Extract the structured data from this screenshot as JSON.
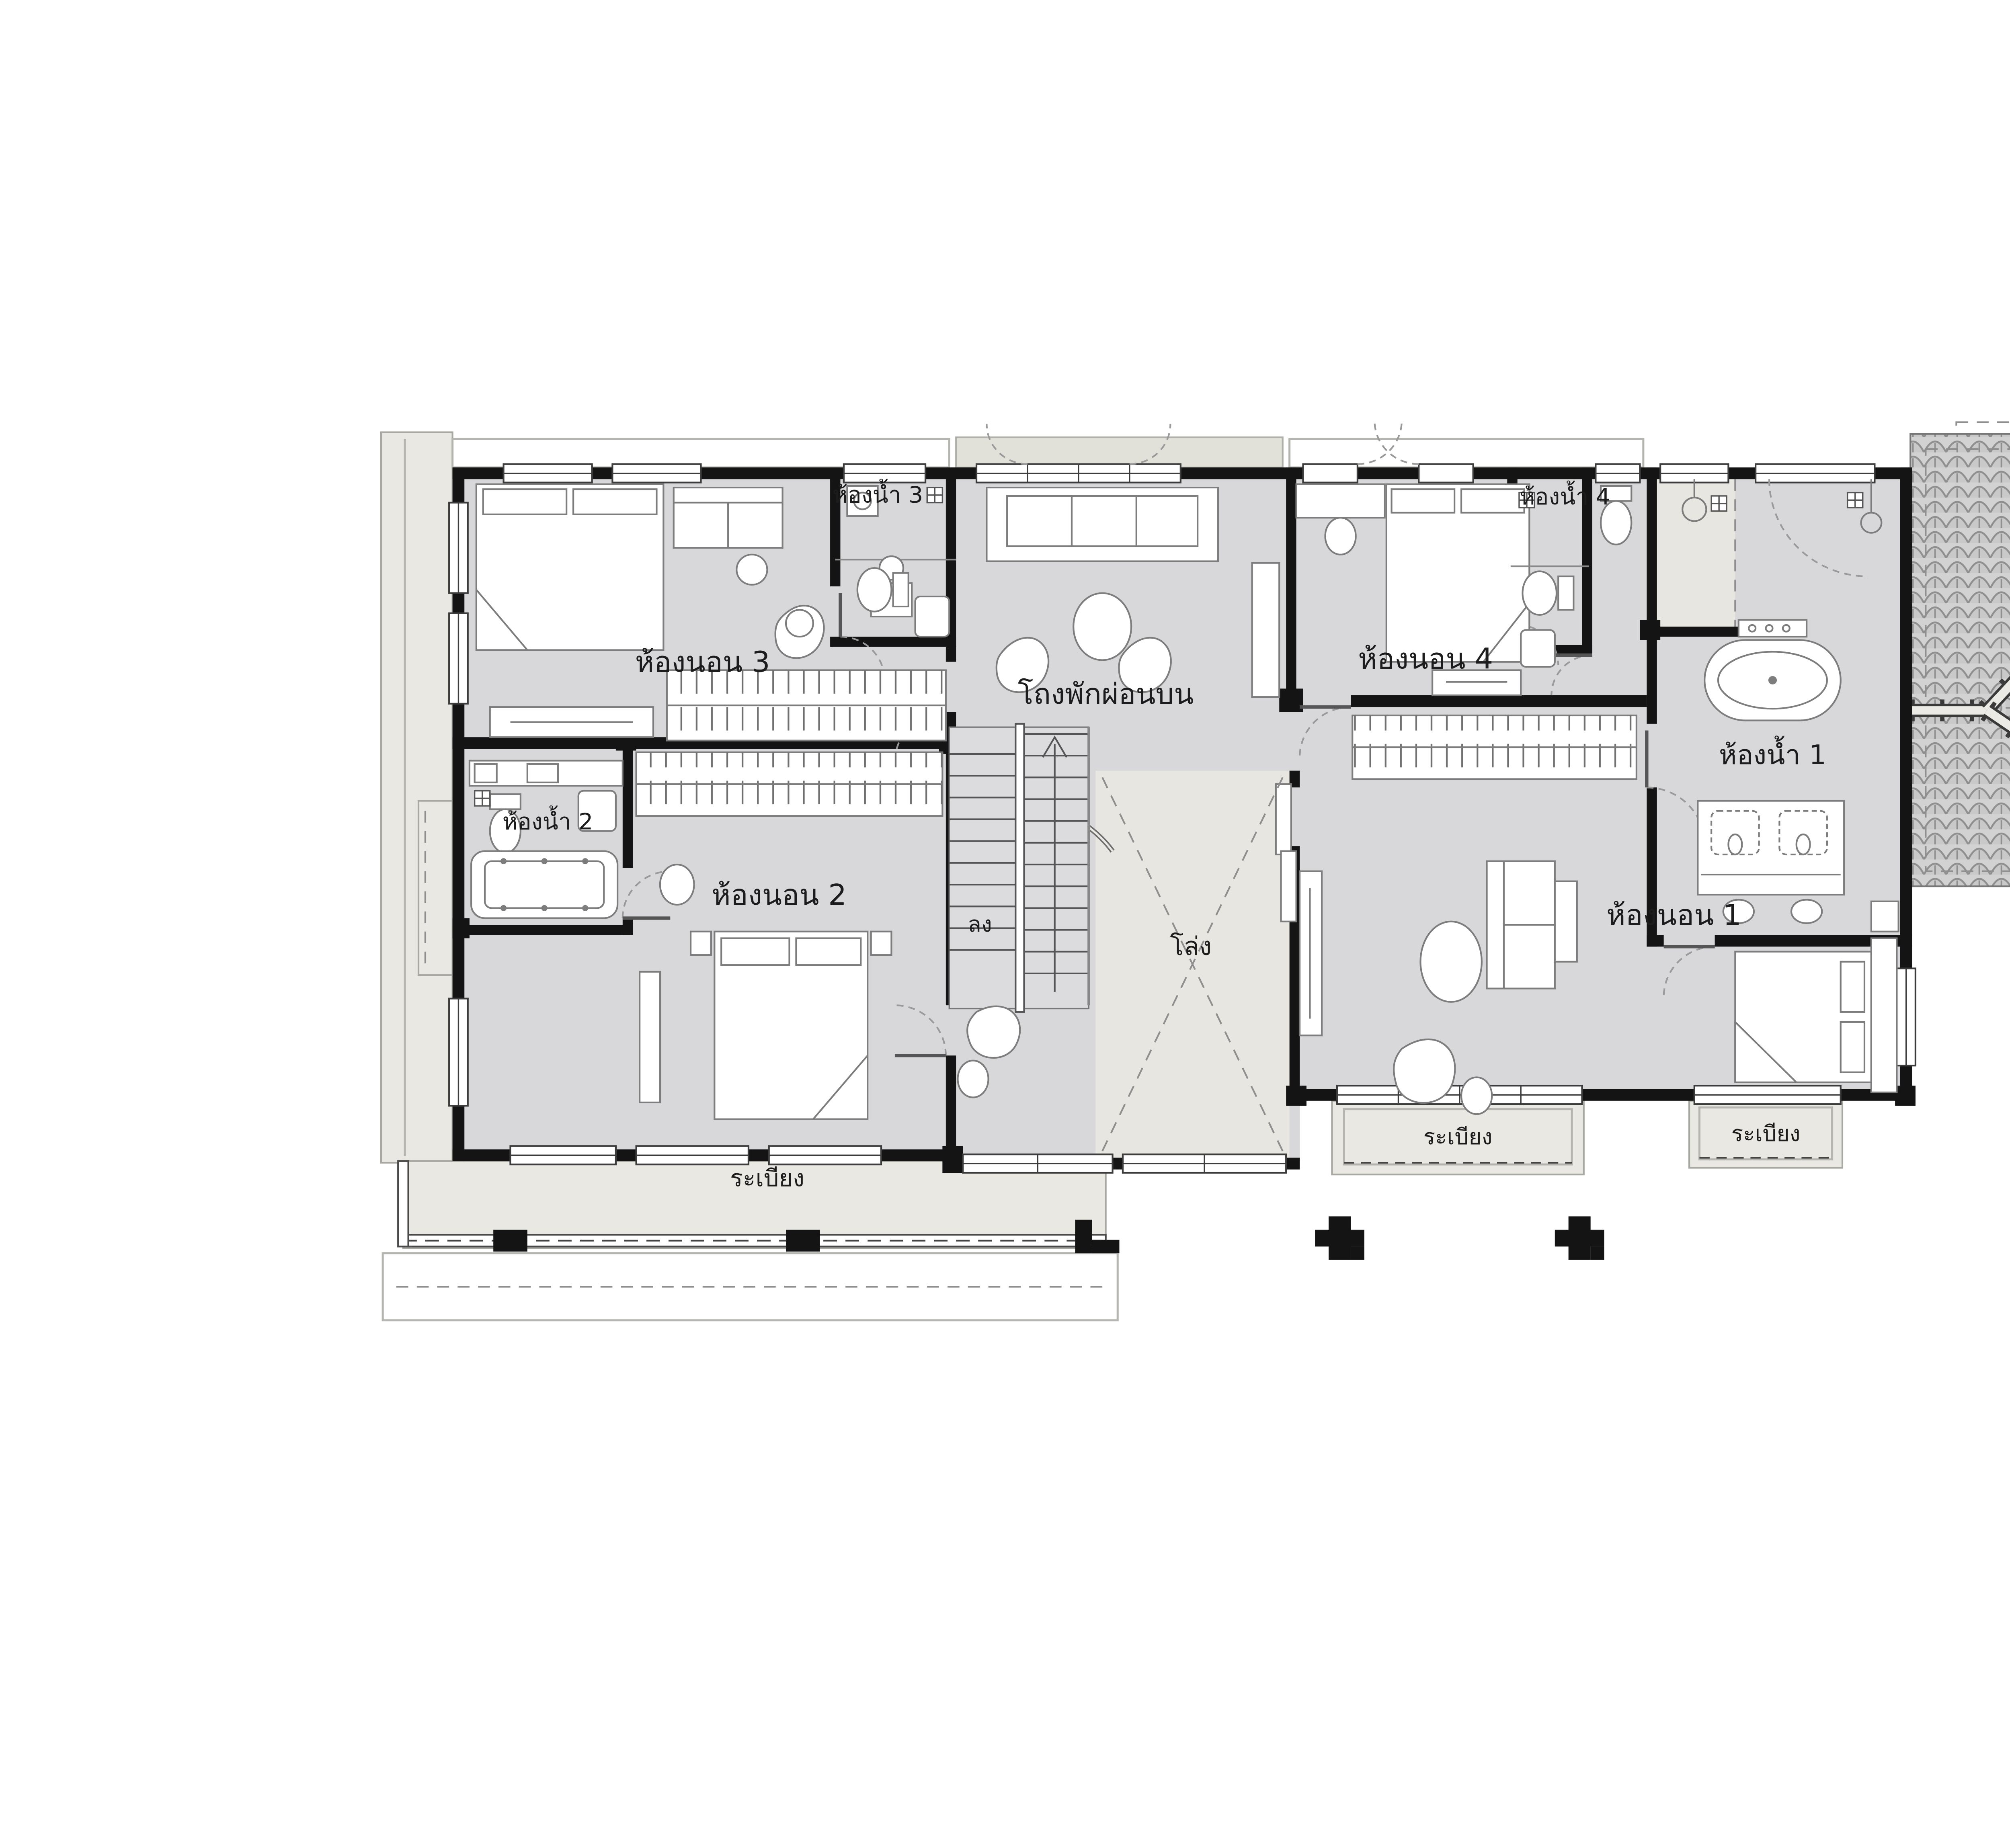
{
  "plan_code": "SH426MCB2/A6 PLAN 2",
  "rooms": {
    "bedroom1": {
      "label": "ห้องนอน 1"
    },
    "bedroom2": {
      "label": "ห้องนอน 2"
    },
    "bedroom3": {
      "label": "ห้องนอน 3"
    },
    "bedroom4": {
      "label": "ห้องนอน 4"
    },
    "bath1": {
      "label": "ห้องน้ำ 1"
    },
    "bath2": {
      "label": "ห้องน้ำ 2"
    },
    "bath3": {
      "label": "ห้องน้ำ 3"
    },
    "bath4": {
      "label": "ห้องน้ำ 4"
    },
    "lounge": {
      "label": "โถงพักผ่อนบน"
    },
    "void": {
      "label": "โล่ง"
    },
    "stairs": {
      "label": "ลง"
    },
    "balcony_main": {
      "label": "ระเบียง"
    },
    "balcony_left": {
      "label": "ระเบียง"
    },
    "balcony_right": {
      "label": "ระเบียง"
    }
  },
  "colors": {
    "wall": "#141414",
    "room_fill": "#d8d8da",
    "terrace_fill": "#e9e8e2",
    "roof_fill": "#d2d2d2",
    "accent_text": "#1a1a1a"
  }
}
